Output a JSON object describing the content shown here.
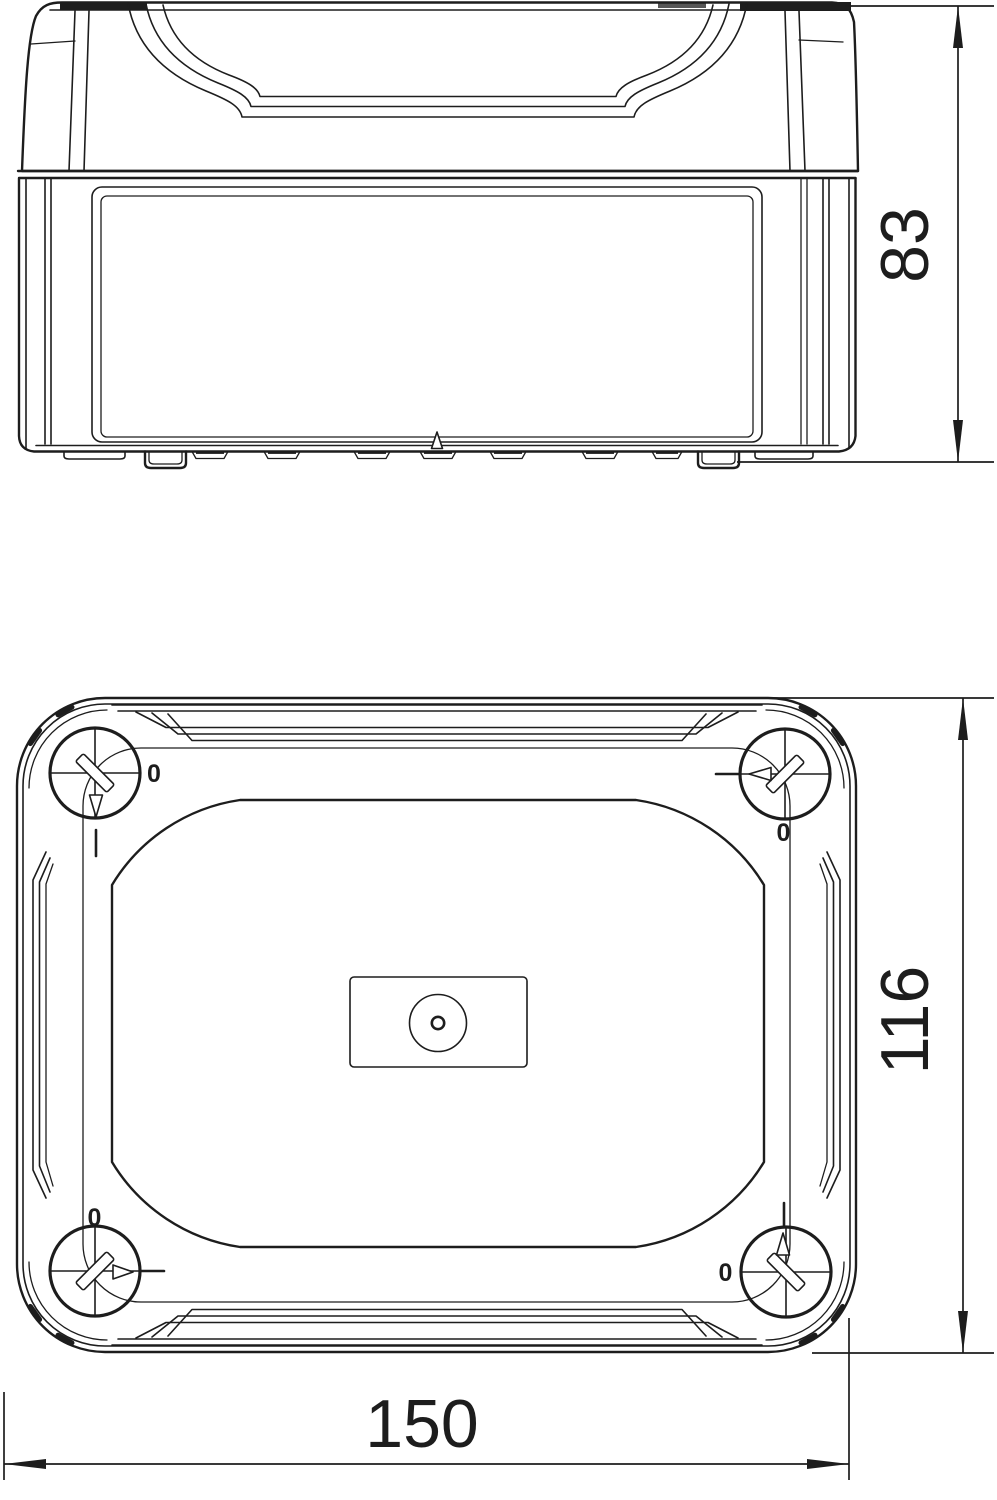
{
  "drawing": {
    "type": "technical-drawing-2-views",
    "background_color": "#ffffff",
    "line_color": "#1d1d1d",
    "views": {
      "side_view": {
        "name": "side-elevation",
        "dimension_height": "83"
      },
      "top_view": {
        "name": "plan-view",
        "dimension_height": "116",
        "dimension_width": "150",
        "screw_zero_marks": "0"
      }
    }
  }
}
